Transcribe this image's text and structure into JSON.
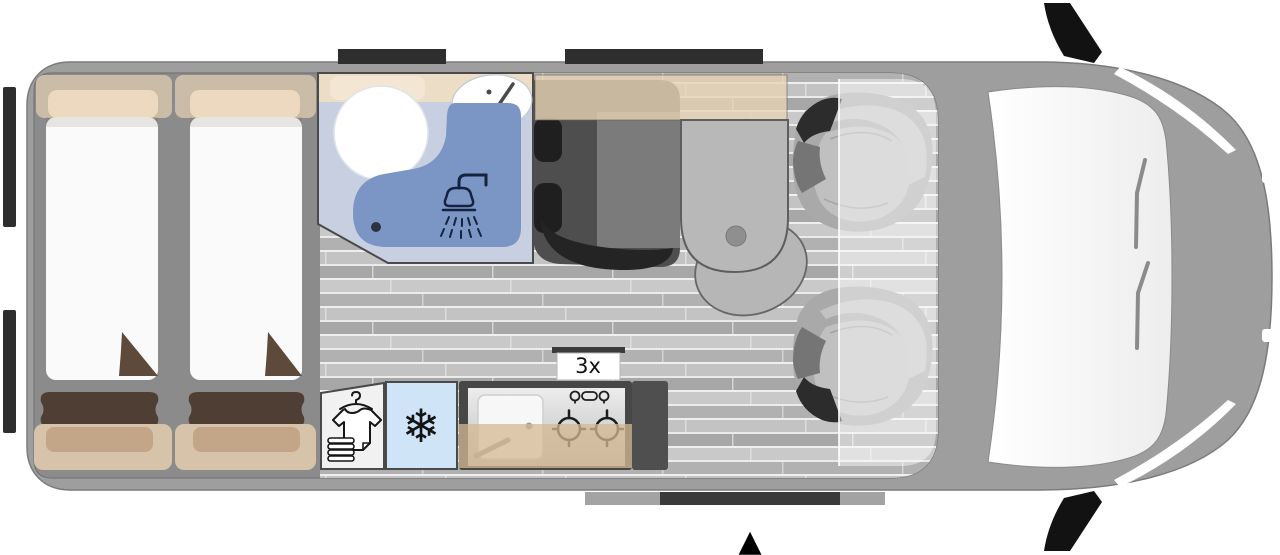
{
  "labels": {
    "burner_count": "3x"
  },
  "icons": {
    "fridge_snowflake": "❄",
    "entrance_arrow": "▲",
    "wardrobe_shirt": "tshirt-on-hanger-with-towel-stack",
    "shower_head": "shower-head-with-spray",
    "kitchen_faucet": "faucet-handle",
    "basin_faucet": "faucet-handle"
  },
  "colors": {
    "page_bg": "#ffffff",
    "van_body": "#9e9e9e",
    "interior": "#8b8b8b",
    "floor_plank": "#bdbdbd",
    "window_trim": "#2e2e2e",
    "bed_linen": "#fafafa",
    "upholstery_beige": "#cbbca7",
    "pillow_brown": "#4f3e33",
    "duvet_fold_brown": "#5d4a3a",
    "bathroom_floor": "#c7cfe0",
    "shower_tray_blue": "#7b95c5",
    "shower_icon_navy": "#14233f",
    "dinette_seat": "#4e4e4e",
    "table_gray": "#b8b8b8",
    "overhead_cabinet": "#e9d2b5",
    "wardrobe_white": "#f1f1f1",
    "fridge_blue": "#cfe4f6",
    "kitchen_frame": "#474747",
    "counter_beige": "#d6b892",
    "windshield_white": "#f6f6f6"
  }
}
